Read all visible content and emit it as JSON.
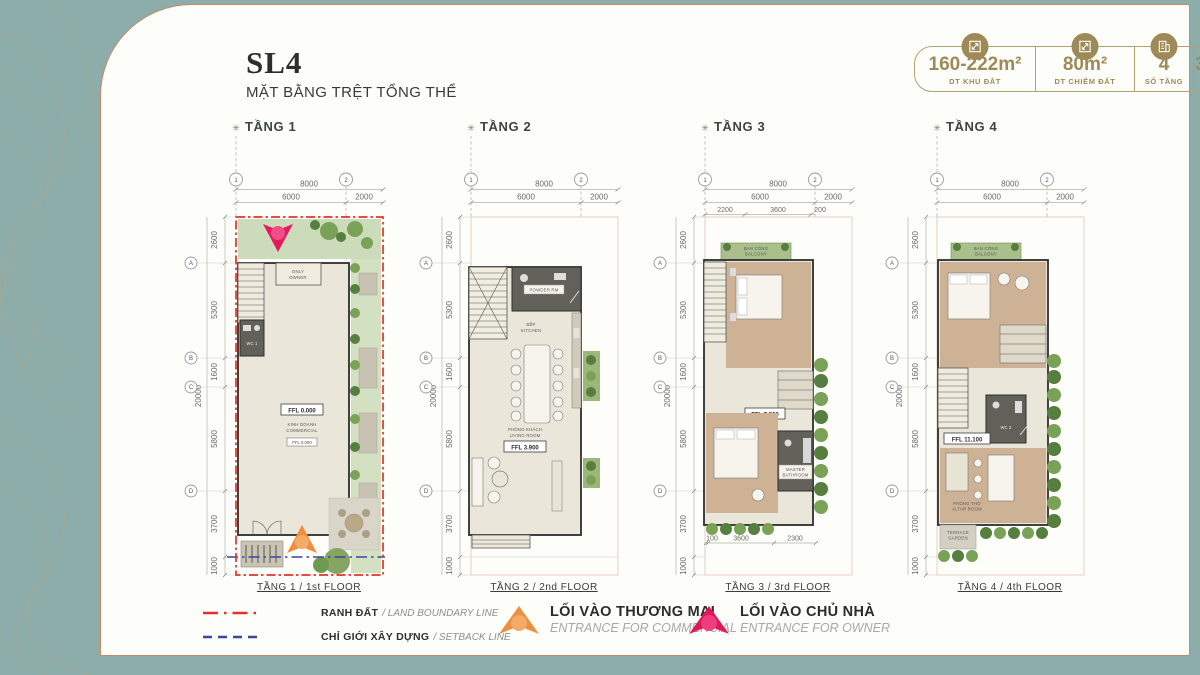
{
  "header": {
    "title": "SL4",
    "subtitle": "MẶT BẰNG TRỆT TỔNG THỂ"
  },
  "stats": [
    {
      "value": "160-222m²",
      "label": "DT KHU ĐẤT",
      "icon": "land-area-icon"
    },
    {
      "value": "80m²",
      "label": "DT CHIẾM ĐẤT",
      "icon": "footprint-area-icon"
    },
    {
      "value": "4",
      "label": "SỐ TẦNG",
      "icon": "floors-icon"
    },
    {
      "value": "36-50%",
      "label": "MĐXD",
      "icon": "density-icon"
    }
  ],
  "grid": {
    "c1": "1",
    "c2": "2",
    "r": [
      "A",
      "B",
      "C",
      "D"
    ]
  },
  "dims": {
    "w": "8000",
    "w1": "6000",
    "w2": "2000",
    "total": "20000",
    "h": [
      "2600",
      "5300",
      "1600",
      "5800",
      "3700",
      "1000"
    ]
  },
  "plans": {
    "p1": {
      "header": "TẦNG 1",
      "caption": "TẦNG 1 / 1st FLOOR",
      "only1": "ONLY",
      "only2": "OWNER",
      "wc": "WC 1",
      "ffl": "FFL 0.000",
      "room_vi": "KINH DOANH",
      "room_en": "COMMERCIAL",
      "ffl2": "FFL 0.000"
    },
    "p2": {
      "header": "TẦNG 2",
      "caption": "TẦNG 2 / 2nd FLOOR",
      "powder": "POWDER RM",
      "kitchen_vi": "BẾP",
      "kitchen_en": "KITCHEN",
      "living_vi": "PHÒNG KHÁCH",
      "living_en": "LIVING ROOM",
      "ffl": "FFL 3.900"
    },
    "p3": {
      "header": "TẦNG 3",
      "caption": "TẦNG 3 / 3rd FLOOR",
      "balcony_vi": "BAN CÔNG",
      "balcony_en": "BALCONY",
      "ffl": "FFL 7.500",
      "bath_1": "MASTER",
      "bath_2": "BATHROOM",
      "sub": [
        "2200",
        "3600",
        "200"
      ],
      "bottom": [
        "100",
        "3600",
        "2300"
      ]
    },
    "p4": {
      "header": "TẦNG 4",
      "caption": "TẦNG 4 / 4th FLOOR",
      "balcony_vi": "BAN CÔNG",
      "balcony_en": "BALCONY",
      "wc": "WC 3",
      "ffl": "FFL 11.100",
      "altar_vi": "PHÒNG THỜ",
      "altar_en": "ALTAR ROOM",
      "terrace_1": "TERRACE",
      "terrace_2": "GARDEN"
    }
  },
  "legend": {
    "boundary_vi": "RANH ĐẤT",
    "boundary_en": "/ LAND BOUNDARY LINE",
    "setback_vi": "CHỈ GIỚI XÂY DỰNG",
    "setback_en": "/ SETBACK LINE",
    "commercial_vi": "LỐI VÀO THƯƠNG MẠI",
    "commercial_en": "ENTRANCE FOR COMMERCIAL",
    "owner_vi": "LỐI VÀO CHỦ NHÀ",
    "owner_en": "ENTRANCE FOR OWNER"
  },
  "icons": {
    "star": "✳"
  },
  "colors": {
    "background_teal": "#8dadaa",
    "panel_border_copper": "#c98a66",
    "accent_gold": "#9d8a57",
    "boundary_red": "#e2322a",
    "setback_blue": "#3d43a0",
    "commercial_orange": "#ee8f3e",
    "owner_pink": "#e6195e"
  }
}
